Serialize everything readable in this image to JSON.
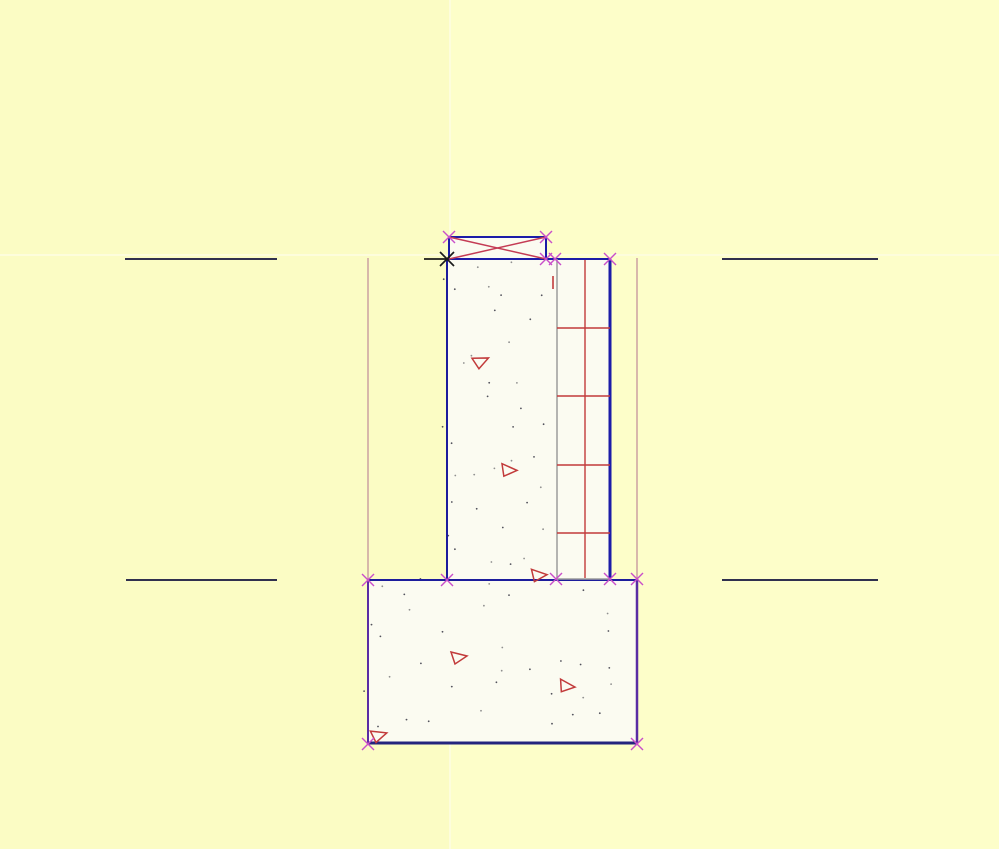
{
  "scene": {
    "type": "cad-drawing",
    "description": "Cross-section detail: concrete wall with masonry veneer on a spread footing, with grip markers and hatch symbols",
    "canvas": {
      "width": 999,
      "height": 849,
      "background": "#FBFCC4"
    },
    "right_tint": {
      "x": 451,
      "color": "#FDFEC9"
    },
    "grid_highlight": {
      "vertical_x": 450,
      "horizontal_y": 255,
      "color": "#FDFDDC",
      "width": 2
    },
    "palette": {
      "object_blue": "#1C1CA8",
      "dark_navy": "#30304E",
      "purple_edge": "#5A2CA4",
      "hatch_red": "#C23B3B",
      "diagonal_red": "#C43B55",
      "grip_magenta": "#C94FC9",
      "extension_pink": "#C4939B",
      "joint_gray": "#9C9C9C",
      "paper_white": "#FBFBF1",
      "pick_black": "#1B1B1B"
    },
    "fills": [
      {
        "name": "footing-body",
        "x": 368,
        "y": 580,
        "w": 269,
        "h": 164,
        "fill": "#FBFBF1"
      },
      {
        "name": "wall-body",
        "x": 447,
        "y": 259,
        "w": 163,
        "h": 321,
        "fill": "#FBFBF1"
      },
      {
        "name": "sill-plate-body",
        "x": 449,
        "y": 237,
        "w": 97,
        "h": 22,
        "fill": "#FBFBF1"
      }
    ],
    "rects": [
      {
        "name": "sill-plate-outline",
        "x": 449,
        "y": 237,
        "w": 97,
        "h": 22,
        "stroke": "#1C1CA8",
        "sw": 2
      }
    ],
    "lines": [
      {
        "name": "adjacent-line-upper-left",
        "p": [
          125,
          259,
          277,
          259
        ],
        "c": "#30304E",
        "w": 2
      },
      {
        "name": "adjacent-line-upper-right",
        "p": [
          722,
          259,
          878,
          259
        ],
        "c": "#30304E",
        "w": 2
      },
      {
        "name": "adjacent-line-lower-left",
        "p": [
          126,
          580,
          277,
          580
        ],
        "c": "#30304E",
        "w": 2
      },
      {
        "name": "adjacent-line-lower-right",
        "p": [
          722,
          580,
          878,
          580
        ],
        "c": "#30304E",
        "w": 2
      },
      {
        "name": "extension-line-left",
        "p": [
          368,
          258,
          368,
          580
        ],
        "c": "#C4939B",
        "w": 1.3
      },
      {
        "name": "extension-line-right",
        "p": [
          637,
          258,
          637,
          579
        ],
        "c": "#C4939B",
        "w": 1.3
      },
      {
        "name": "footing-top-edge",
        "p": [
          368,
          580,
          637,
          580
        ],
        "c": "#1C1C9C",
        "w": 2
      },
      {
        "name": "footing-bottom-edge",
        "p": [
          368,
          743,
          637,
          743
        ],
        "c": "#24247E",
        "w": 3
      },
      {
        "name": "footing-left-edge",
        "p": [
          368,
          580,
          368,
          743
        ],
        "c": "#5A2CA4",
        "w": 2
      },
      {
        "name": "footing-right-edge",
        "p": [
          637,
          579,
          637,
          743
        ],
        "c": "#5A2CA4",
        "w": 2.5
      },
      {
        "name": "wall-left-edge",
        "p": [
          447,
          259,
          447,
          580
        ],
        "c": "#1C1C9C",
        "w": 2
      },
      {
        "name": "wall-top-edge",
        "p": [
          447,
          259,
          610,
          259
        ],
        "c": "#1C1CA8",
        "w": 2
      },
      {
        "name": "wall-veneer-joint-line",
        "p": [
          557,
          259,
          557,
          580
        ],
        "c": "#9C9C9C",
        "w": 1.5
      },
      {
        "name": "veneer-center-line",
        "p": [
          585,
          260,
          585,
          578
        ],
        "c": "#C23B3B",
        "w": 1.4
      },
      {
        "name": "veneer-right-edge",
        "p": [
          610,
          259,
          610,
          578
        ],
        "c": "#1C1CA8",
        "w": 3
      },
      {
        "name": "veneer-bottom-line",
        "p": [
          557,
          579,
          610,
          579
        ],
        "c": "#9C9C9C",
        "w": 1.5
      },
      {
        "name": "masonry-course-1",
        "p": [
          557,
          328,
          610,
          328
        ],
        "c": "#C23B3B",
        "w": 1.4
      },
      {
        "name": "masonry-course-2",
        "p": [
          557,
          396,
          610,
          396
        ],
        "c": "#C23B3B",
        "w": 1.4
      },
      {
        "name": "masonry-course-3",
        "p": [
          557,
          465,
          610,
          465
        ],
        "c": "#C23B3B",
        "w": 1.4
      },
      {
        "name": "masonry-course-4",
        "p": [
          557,
          533,
          610,
          533
        ],
        "c": "#C23B3B",
        "w": 1.4
      },
      {
        "name": "red-tick-mark",
        "p": [
          553,
          276,
          553,
          289
        ],
        "c": "#C23B3B",
        "w": 1.6
      },
      {
        "name": "plate-diagonal-1",
        "p": [
          449,
          237,
          546,
          259
        ],
        "c": "#C43B55",
        "w": 1.5
      },
      {
        "name": "plate-diagonal-2",
        "p": [
          449,
          259,
          546,
          237
        ],
        "c": "#C43B55",
        "w": 1.5
      }
    ],
    "grip_markers": {
      "color": "#C94FC9",
      "half": 6,
      "w": 1.4,
      "points": [
        [
          449,
          237
        ],
        [
          546,
          237
        ],
        [
          546,
          259
        ],
        [
          555,
          259
        ],
        [
          610,
          259
        ],
        [
          556,
          579
        ],
        [
          610,
          579
        ],
        [
          637,
          579
        ],
        [
          368,
          580
        ],
        [
          447,
          580
        ],
        [
          368,
          744
        ],
        [
          637,
          744
        ]
      ]
    },
    "pick_marker": {
      "x": 447,
      "y": 259,
      "half": 7,
      "w": 1.7,
      "color": "#1B1B1B",
      "tick": [
        424,
        259,
        446,
        259
      ]
    },
    "triangles": {
      "color": "#C23B3B",
      "w": 1.5,
      "items": [
        {
          "x": 481,
          "y": 361,
          "r": -15
        },
        {
          "x": 509,
          "y": 470,
          "r": 10
        },
        {
          "x": 539,
          "y": 575,
          "r": 5
        },
        {
          "x": 459,
          "y": 657,
          "r": 0
        },
        {
          "x": 567,
          "y": 686,
          "r": 15
        },
        {
          "x": 379,
          "y": 735,
          "r": -8
        }
      ]
    },
    "dot_hatch": {
      "seed": 7,
      "step": 26,
      "keep": 0.68,
      "colors": [
        "#8F8F8F",
        "#52525C"
      ],
      "regions": [
        {
          "name": "wall-stipple",
          "x": 454,
          "y": 268,
          "w": 94,
          "h": 305
        },
        {
          "name": "footing-stipple",
          "x": 374,
          "y": 589,
          "w": 256,
          "h": 148
        }
      ]
    }
  }
}
